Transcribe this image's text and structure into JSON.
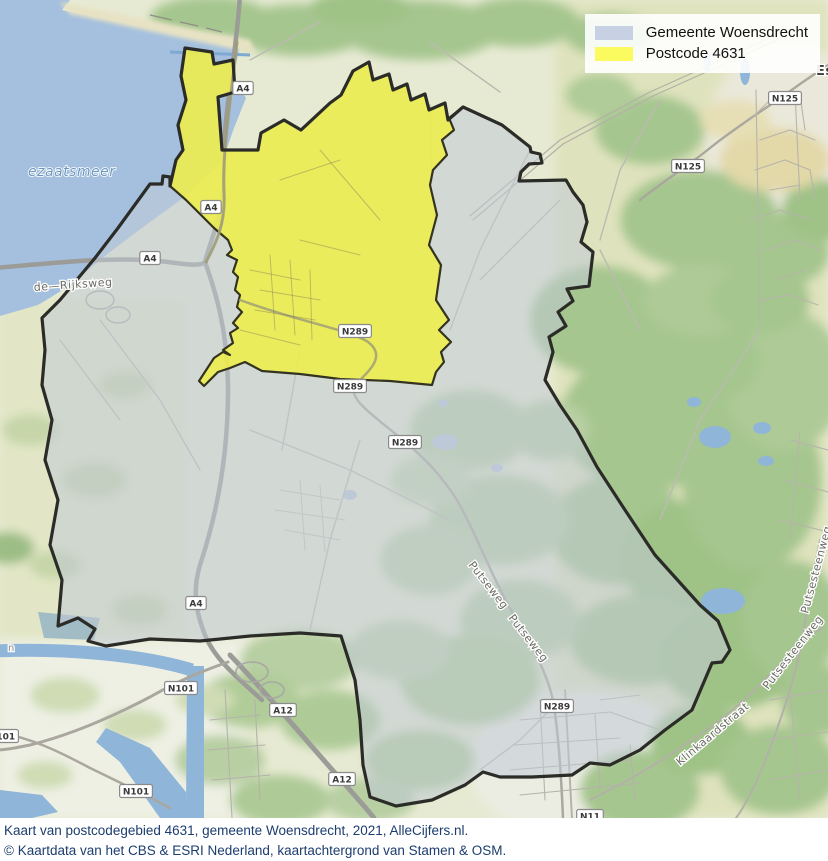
{
  "legend": {
    "items": [
      {
        "label": "Gemeente Woensdrecht",
        "color": "#c7d1e3"
      },
      {
        "label": "Postcode 4631",
        "color": "#fbfa5f"
      }
    ]
  },
  "caption": {
    "line1": "Kaart van postcodegebied 4631, gemeente Woensdrecht, 2021, AlleCijfers.nl.",
    "line2": "© Kaartdata van het CBS & ESRI Nederland, kaartachtergrond van Stamen & OSM."
  },
  "map": {
    "colors": {
      "municipality_fill": "rgba(193,202,213,0.55)",
      "postcode_fill": "rgba(240,238,70,0.85)",
      "boundary": "#2b2b28",
      "water": "#8fb5d8",
      "forest": "#a6c68f"
    },
    "road_badges": [
      {
        "label": "A4",
        "x": 243,
        "y": 88
      },
      {
        "label": "A4",
        "x": 211,
        "y": 207
      },
      {
        "label": "A4",
        "x": 150,
        "y": 258
      },
      {
        "label": "A4",
        "x": 196,
        "y": 603
      },
      {
        "label": "N289",
        "x": 355,
        "y": 331
      },
      {
        "label": "N289",
        "x": 350,
        "y": 386
      },
      {
        "label": "N289",
        "x": 405,
        "y": 442
      },
      {
        "label": "N289",
        "x": 557,
        "y": 706
      },
      {
        "label": "N125",
        "x": 785,
        "y": 98
      },
      {
        "label": "N125",
        "x": 688,
        "y": 166
      },
      {
        "label": "N101",
        "x": 181,
        "y": 688
      },
      {
        "label": "N101",
        "x": 136,
        "y": 791
      },
      {
        "label": "N101",
        "x": 2,
        "y": 736
      },
      {
        "label": "A12",
        "x": 283,
        "y": 710
      },
      {
        "label": "A12",
        "x": 342,
        "y": 779
      },
      {
        "label": "N11",
        "x": 590,
        "y": 816
      }
    ],
    "street_labels": [
      {
        "text": "Putseweg",
        "x": 468,
        "y": 565,
        "rotate": 52,
        "style": ""
      },
      {
        "text": "Putseweg",
        "x": 508,
        "y": 618,
        "rotate": 52,
        "style": ""
      },
      {
        "text": "Putsesteenweg",
        "x": 768,
        "y": 690,
        "rotate": -52,
        "style": ""
      },
      {
        "text": "Putsesteenweg",
        "x": 808,
        "y": 614,
        "rotate": -75,
        "style": ""
      },
      {
        "text": "Klinkaardstraat",
        "x": 680,
        "y": 766,
        "rotate": -40,
        "style": ""
      },
      {
        "text": "de—Rijksweg",
        "x": 34,
        "y": 291,
        "rotate": -4,
        "style": ""
      },
      {
        "text": "ezaatsmeer",
        "x": 28,
        "y": 176,
        "rotate": 0,
        "style": "water"
      },
      {
        "text": "Ess",
        "x": 816,
        "y": 75,
        "rotate": 0,
        "style": "town"
      },
      {
        "text": "n",
        "x": 8,
        "y": 651,
        "rotate": 0,
        "style": "tiny"
      }
    ]
  }
}
